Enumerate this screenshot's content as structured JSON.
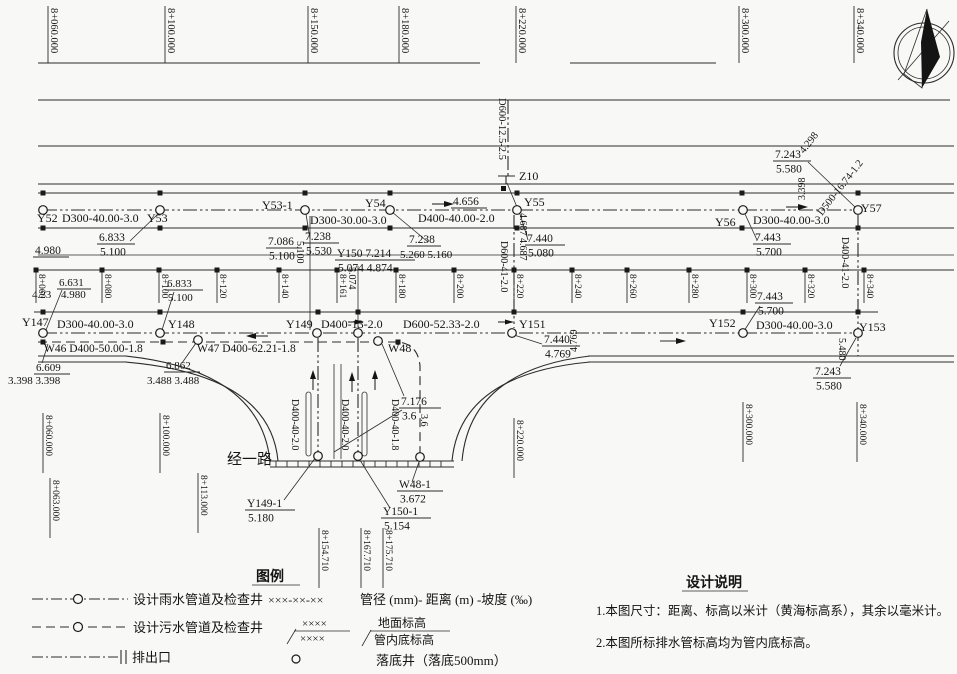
{
  "compass": {
    "icon": "north-arrow"
  },
  "stations": {
    "top": [
      {
        "t": "8+060.000",
        "x": 48
      },
      {
        "t": "8+100.000",
        "x": 165
      },
      {
        "t": "8+150.000",
        "x": 308
      },
      {
        "t": "8+180.000",
        "x": 399
      },
      {
        "t": "8+220.000",
        "x": 516
      },
      {
        "t": "8+300.000",
        "x": 739
      },
      {
        "t": "8+340.000",
        "x": 854
      }
    ],
    "band": [
      {
        "t": "8+060",
        "x": 36
      },
      {
        "t": "8+080",
        "x": 102
      },
      {
        "t": "8+100",
        "x": 159
      },
      {
        "t": "8+120",
        "x": 217
      },
      {
        "t": "8+140",
        "x": 279
      },
      {
        "t": "8+161",
        "x": 337
      },
      {
        "t": "8+180",
        "x": 396
      },
      {
        "t": "8+200",
        "x": 454
      },
      {
        "t": "8+220",
        "x": 514
      },
      {
        "t": "8+240",
        "x": 572
      },
      {
        "t": "8+260",
        "x": 627
      },
      {
        "t": "8+280",
        "x": 689
      },
      {
        "t": "8+300",
        "x": 747
      },
      {
        "t": "8+320",
        "x": 805
      },
      {
        "t": "8+340",
        "x": 864
      }
    ],
    "bottom": [
      {
        "t": "8+060.000",
        "x": 43,
        "y": 413
      },
      {
        "t": "8+100.000",
        "x": 160,
        "y": 413
      },
      {
        "t": "8+063.000",
        "x": 50,
        "y": 478
      },
      {
        "t": "8+113.000",
        "x": 198,
        "y": 473
      },
      {
        "t": "8+154.710",
        "x": 319,
        "y": 528
      },
      {
        "t": "8+167.710",
        "x": 361,
        "y": 528
      },
      {
        "t": "8+175.710",
        "x": 383,
        "y": 528
      },
      {
        "t": "8+220.000",
        "x": 514,
        "y": 418
      },
      {
        "t": "8+300.000",
        "x": 743,
        "y": 402
      },
      {
        "t": "8+340.000",
        "x": 857,
        "y": 402
      }
    ]
  },
  "plan": {
    "texts": [
      {
        "t": "Y52",
        "x": 37,
        "y": 222
      },
      {
        "t": "D300-40.00-3.0",
        "x": 62,
        "y": 222
      },
      {
        "t": "Y53",
        "x": 147,
        "y": 222
      },
      {
        "t": "Y53-1",
        "x": 262,
        "y": 209
      },
      {
        "t": "Y54",
        "x": 365,
        "y": 207
      },
      {
        "t": "D300-30.00-3.0",
        "x": 310,
        "y": 224
      },
      {
        "t": "D400-40.00-2.0",
        "x": 418,
        "y": 222
      },
      {
        "t": "Z10",
        "x": 519,
        "y": 180
      },
      {
        "t": "Y55",
        "x": 524,
        "y": 206
      },
      {
        "t": "Y56",
        "x": 715,
        "y": 226
      },
      {
        "t": "D300-40.00-3.0",
        "x": 753,
        "y": 224
      },
      {
        "t": "Y57",
        "x": 861,
        "y": 212
      },
      {
        "t": "Y147",
        "x": 22,
        "y": 326
      },
      {
        "t": "D300-40.00-3.0",
        "x": 57,
        "y": 328
      },
      {
        "t": "Y148",
        "x": 168,
        "y": 328
      },
      {
        "t": "Y149",
        "x": 286,
        "y": 328
      },
      {
        "t": "D400-13-2.0",
        "x": 321,
        "y": 328
      },
      {
        "t": "D600-52.33-2.0",
        "x": 403,
        "y": 328
      },
      {
        "t": "Y151",
        "x": 519,
        "y": 328
      },
      {
        "t": "Y152",
        "x": 709,
        "y": 327
      },
      {
        "t": "D300-40.00-3.0",
        "x": 756,
        "y": 329
      },
      {
        "t": "Y153",
        "x": 859,
        "y": 331
      },
      {
        "t": "W46 D400-50.00-1.8",
        "x": 44,
        "y": 352,
        "fs": 11.5
      },
      {
        "t": "W47 D400-62.21-1.8",
        "x": 197,
        "y": 352,
        "fs": 11.5
      },
      {
        "t": "W48",
        "x": 388,
        "y": 352
      },
      {
        "t": "4.23",
        "x": 32,
        "y": 298,
        "fs": 11
      },
      {
        "t": "4.980",
        "x": 61,
        "y": 298,
        "fs": 11
      },
      {
        "t": "3.398 3.398",
        "x": 8,
        "y": 384,
        "fs": 11
      },
      {
        "t": "3.488 3.488",
        "x": 147,
        "y": 384,
        "fs": 11
      },
      {
        "t": "5.260 5.160",
        "x": 400,
        "y": 258,
        "fs": 11
      },
      {
        "t": "经一路",
        "x": 227,
        "y": 464,
        "fs": 15
      }
    ],
    "fracs": [
      {
        "top": "6.833",
        "bot": "5.100",
        "x": 97,
        "y": 244,
        "w": 38
      },
      {
        "top": "4.980",
        "bot": "",
        "x": 33,
        "y": 257,
        "w": 36
      },
      {
        "top": "7.086",
        "bot": "5.100",
        "x": 266,
        "y": 248,
        "w": 36
      },
      {
        "top": "7.238",
        "bot": "5.530",
        "x": 303,
        "y": 243,
        "w": 36
      },
      {
        "top": "Y150 7.214",
        "bot": "5.074 4.874",
        "x": 335,
        "y": 260,
        "w": 80
      },
      {
        "top": "7.238",
        "bot": "",
        "x": 407,
        "y": 246,
        "w": 34
      },
      {
        "top": "4.656",
        "bot": "",
        "x": 451,
        "y": 208,
        "w": 36
      },
      {
        "top": "7.440",
        "bot": "5.080",
        "x": 525,
        "y": 245,
        "w": 40
      },
      {
        "top": "7.443",
        "bot": "5.700",
        "x": 753,
        "y": 244,
        "w": 38
      },
      {
        "top": "7.243",
        "bot": "5.580",
        "x": 773,
        "y": 161,
        "w": 38
      },
      {
        "top": "6.631",
        "bot": "",
        "x": 57,
        "y": 289,
        "w": 34,
        "fs": 11
      },
      {
        "top": "6.833",
        "bot": "5.100",
        "x": 165,
        "y": 290,
        "w": 38,
        "fs": 11
      },
      {
        "top": "6.609",
        "bot": "",
        "x": 34,
        "y": 374,
        "w": 36,
        "fs": 11
      },
      {
        "top": "6.862",
        "bot": "",
        "x": 164,
        "y": 372,
        "w": 36,
        "fs": 11
      },
      {
        "top": "7.440",
        "bot": "4.769",
        "x": 542,
        "y": 346,
        "w": 38
      },
      {
        "top": "7.443",
        "bot": "5.700",
        "x": 755,
        "y": 303,
        "w": 38
      },
      {
        "top": "7.243",
        "bot": "5.580",
        "x": 813,
        "y": 378,
        "w": 38
      },
      {
        "top": "7.176",
        "bot": "3.6",
        "x": 399,
        "y": 408,
        "w": 42
      },
      {
        "top": "W48-1",
        "bot": "3.672",
        "x": 397,
        "y": 491,
        "w": 46
      },
      {
        "top": "Y149-1",
        "bot": "5.180",
        "x": 245,
        "y": 510,
        "w": 50
      },
      {
        "top": "Y150-1",
        "bot": "5.154",
        "x": 381,
        "y": 518,
        "w": 50
      }
    ],
    "rotated": [
      {
        "t": "D600-12.5-2.5",
        "x": 499,
        "y": 98,
        "fs": 10.5
      },
      {
        "t": "4.687 4.687",
        "x": 520,
        "y": 213
      },
      {
        "t": "D600-41-2.0",
        "x": 501,
        "y": 241
      },
      {
        "t": "D400-41-2.0",
        "x": 842,
        "y": 237
      },
      {
        "t": "5.480",
        "x": 839,
        "y": 338
      },
      {
        "t": "5.100",
        "x": 297,
        "y": 241
      },
      {
        "t": "5.074",
        "x": 349,
        "y": 267
      },
      {
        "t": "4.769",
        "x": 577,
        "y": 352,
        "r": -90
      },
      {
        "t": "3.398",
        "x": 805,
        "y": 200,
        "r": -90
      },
      {
        "t": "4.298",
        "x": 804,
        "y": 154,
        "r": -52,
        "fs": 10.5
      },
      {
        "t": "D500-16.74-1.2",
        "x": 822,
        "y": 216,
        "r": -52,
        "fs": 10.5
      },
      {
        "t": "D400-40-2.0",
        "x": 292,
        "y": 399
      },
      {
        "t": "D400-40-2.0",
        "x": 342,
        "y": 399
      },
      {
        "t": "D400-40-1.8",
        "x": 392,
        "y": 399
      },
      {
        "t": "3.6",
        "x": 421,
        "y": 414
      }
    ]
  },
  "legend": {
    "title": "图例",
    "rain_label": "设计雨水管道及检查井",
    "rain_code": "×××-××-××",
    "rain_desc": "管径 (mm)- 距离 (m) -坡度 (‰)",
    "sewer_label": "设计污水管道及检查井",
    "elev_top": "××××",
    "elev_bot": "××××",
    "ground_label": "地面标高",
    "invert_label": "管内底标高",
    "outfall_label": "排出口",
    "drop_label": "落底井（落底500mm）"
  },
  "notes": {
    "title": "设计说明",
    "n1": "1.本图尺寸：距离、标高以米计（黄海标高系），其余以毫米计。",
    "n2": "2.本图所标排水管标高均为管内底标高。"
  }
}
